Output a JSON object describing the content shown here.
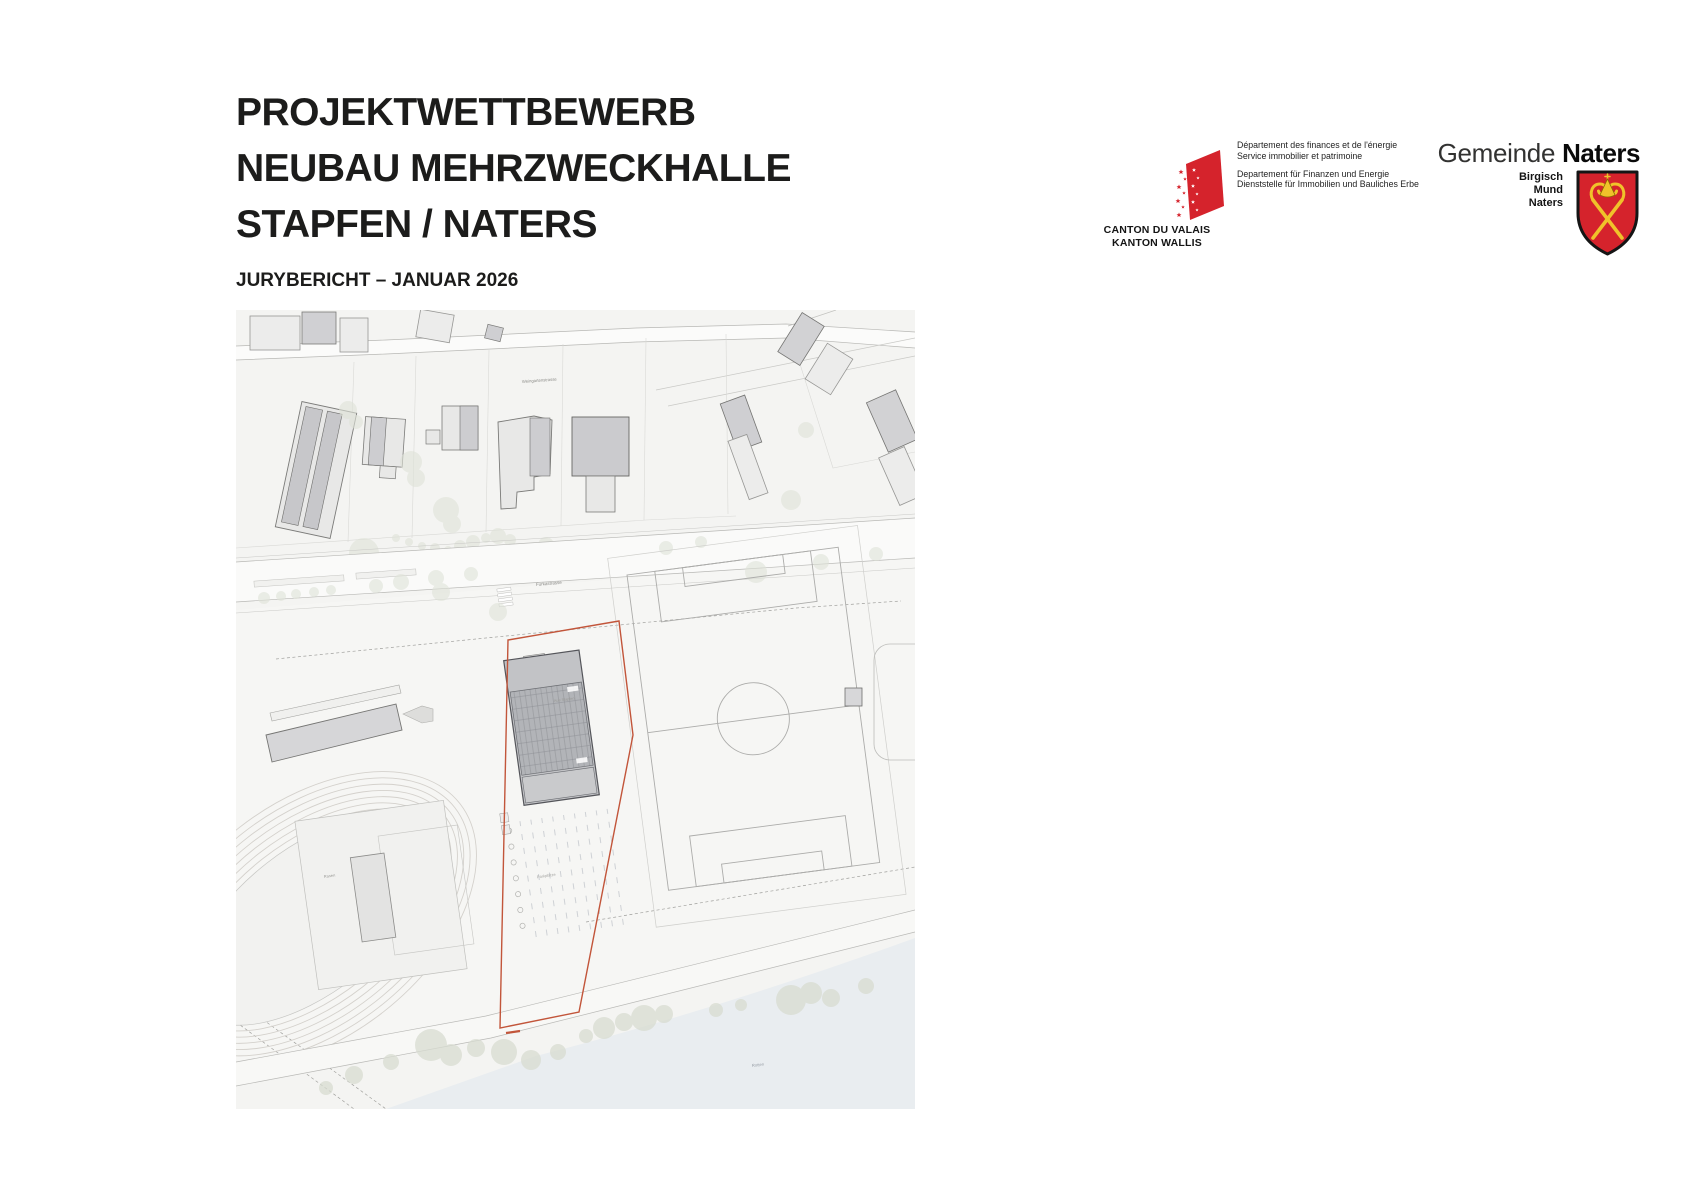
{
  "header": {
    "title_lines": [
      "PROJEKTWETTBEWERB",
      "NEUBAU MEHRZWECKHALLE",
      "STAPFEN / NATERS"
    ],
    "subtitle": "JURYBERICHT – JANUAR 2026"
  },
  "logos": {
    "canton": {
      "caption_fr": "CANTON DU VALAIS",
      "caption_de": "KANTON WALLIS",
      "dept_fr_line1": "Département des finances et de l'énergie",
      "dept_fr_line2": "Service immobilier et patrimoine",
      "dept_de_line1": "Departement für Finanzen und Energie",
      "dept_de_line2": "Dienststelle für Immobilien und Bauliches Erbe",
      "flag_red": "#d5232c"
    },
    "naters": {
      "municipality_light": "Gemeinde",
      "municipality_bold": "Naters",
      "villages": [
        "Birgisch",
        "Mund",
        "Naters"
      ],
      "shield_red": "#d5232c",
      "shield_gold": "#f0c22a"
    }
  },
  "map": {
    "street_label_top": "Weingartenstrasse",
    "street_label_main": "Furkastrasse",
    "area_label": "Aue Stapfen",
    "field_label": "Rasen",
    "parking_label": "Parkplätze",
    "river_label": "Rotten",
    "site_outline_color": "#c2553a"
  }
}
